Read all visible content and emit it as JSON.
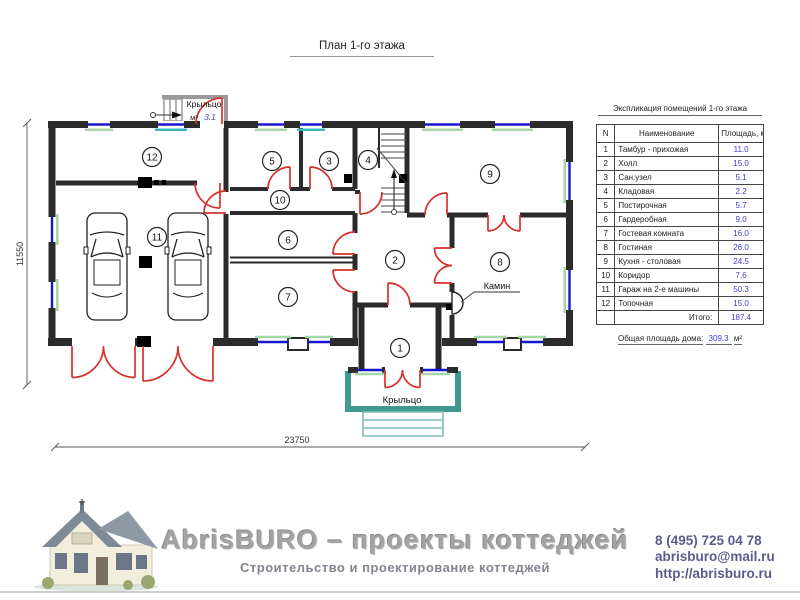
{
  "title": "План 1-го этажа",
  "plan": {
    "porch_top": {
      "label": "Крыльцо",
      "unit": "м²",
      "area": "3.1"
    },
    "porch_bottom_label": "Крыльцо",
    "fireplace_label": "Камин",
    "dim_width": "23750",
    "dim_height": "11550",
    "room_markers": [
      {
        "n": "1",
        "x": 400,
        "y": 348
      },
      {
        "n": "2",
        "x": 395,
        "y": 260
      },
      {
        "n": "3",
        "x": 329,
        "y": 161
      },
      {
        "n": "4",
        "x": 368,
        "y": 160
      },
      {
        "n": "5",
        "x": 272,
        "y": 161
      },
      {
        "n": "6",
        "x": 288,
        "y": 240
      },
      {
        "n": "7",
        "x": 288,
        "y": 297
      },
      {
        "n": "8",
        "x": 500,
        "y": 262
      },
      {
        "n": "9",
        "x": 490,
        "y": 174
      },
      {
        "n": "10",
        "x": 280,
        "y": 200
      },
      {
        "n": "11",
        "x": 157,
        "y": 237
      },
      {
        "n": "12",
        "x": 152,
        "y": 157
      }
    ]
  },
  "legend_table": {
    "title": "Экспликация помещений 1-го этажа",
    "columns": [
      "N",
      "Наименование",
      "Площадь, м²"
    ],
    "rows": [
      [
        "1",
        "Тамбур - прихожая",
        "11.0"
      ],
      [
        "2",
        "Холл",
        "15.0"
      ],
      [
        "3",
        "Сан.узел",
        "5.1"
      ],
      [
        "4",
        "Кладовая",
        "2.2"
      ],
      [
        "5",
        "Постирочная",
        "5.7"
      ],
      [
        "6",
        "Гардеробная",
        "9.0"
      ],
      [
        "7",
        "Гостевая комната",
        "16.0"
      ],
      [
        "8",
        "Гостиная",
        "26.0"
      ],
      [
        "9",
        "Кухня - столовая",
        "24.5"
      ],
      [
        "10",
        "Коридор",
        "7.6"
      ],
      [
        "11",
        "Гараж на 2-е машины",
        "50.3"
      ],
      [
        "12",
        "Топочная",
        "15.0"
      ]
    ],
    "total_label": "Итого:",
    "total_value": "187.4",
    "overall_label": "Общая площадь дома:",
    "overall_value": "309.3",
    "overall_unit": "м²"
  },
  "footer": {
    "brand": "AbrisBURO – проекты коттеджей",
    "tagline": "Строительство и проектирование коттеджей",
    "phone": "8 (495) 725 04 78",
    "email": "abrisburo@mail.ru",
    "site": "http://abrisburo.ru"
  },
  "colors": {
    "wall": "#2b2b2b",
    "door": "#d7312b",
    "win": "#1616cf",
    "sill": "#a5d6a5",
    "sill2": "#39b9be",
    "porch": "#3f9a8e",
    "porchlight": "#7fbcb4",
    "value": "#3b3bd0",
    "brand": "#a3a3a3",
    "tagline": "#84848e",
    "contact": "#5b5b8c",
    "rule": "#cccccc"
  }
}
